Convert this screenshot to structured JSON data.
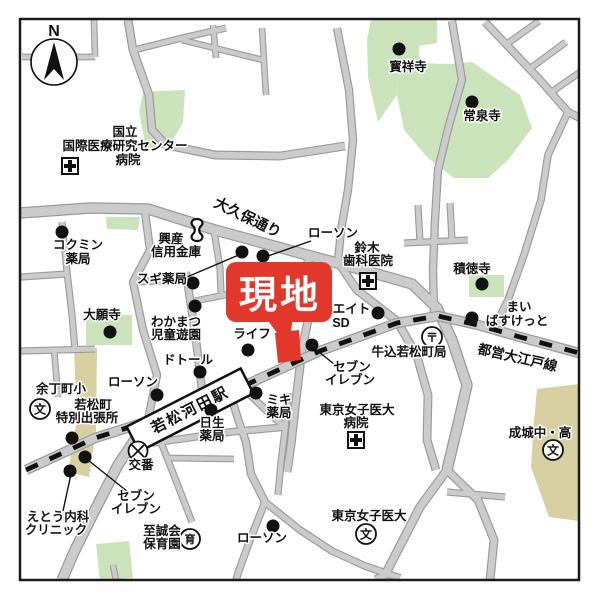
{
  "map": {
    "compass": {
      "label": "N"
    },
    "site": {
      "callout_label": "現地"
    },
    "station": {
      "label": "若松河田駅"
    },
    "railway": {
      "label": "都営大江戸線"
    },
    "streets": {
      "okubo": {
        "label": "大久保通り"
      }
    },
    "colors": {
      "site_red": "#e2382b",
      "road_fill": "#cbcbcb",
      "road_edge": "#9b9b9b",
      "park_green": "#cbe3ba",
      "school_khaki": "#d8d0a0",
      "railway_black": "#111111",
      "frame_black": "#1a1a1a"
    },
    "symbols": {
      "school_glyph": "文",
      "post_glyph": "〒",
      "nursery_glyph": "育"
    },
    "landmarks": {
      "nimc_hospital": {
        "lines": [
          "国立",
          "国際医療研究センター",
          "病院"
        ]
      },
      "hoshoji": {
        "label": "寳祥寺"
      },
      "josenji": {
        "label": "常泉寺"
      },
      "kokumin_pharmacy": {
        "lines": [
          "コクミン",
          "薬局"
        ]
      },
      "kosan_shinkin": {
        "lines": [
          "興産",
          "信用金庫"
        ]
      },
      "sugi_pharmacy": {
        "label": "スギ薬局"
      },
      "lawson_north": {
        "label": "ローソン"
      },
      "suzuki_dental": {
        "lines": [
          "鈴木",
          "歯科医院"
        ]
      },
      "sekitokuji": {
        "label": "積徳寺"
      },
      "my_basket": {
        "lines": [
          "まい",
          "ばすけっと"
        ]
      },
      "create_sd": {
        "lines": [
          "クリエイト",
          "SD"
        ]
      },
      "ushigome_wakamatsucho_post": {
        "label": "牛込若松町局"
      },
      "daiganji": {
        "label": "大願寺"
      },
      "wakamatsu_playground": {
        "lines": [
          "わかまつ",
          "児童遊園"
        ]
      },
      "life_supermarket": {
        "label": "ライフ"
      },
      "seven_eleven_center": {
        "lines": [
          "セブン",
          "イレブン"
        ]
      },
      "doutor": {
        "label": "ドトール"
      },
      "lawson_west": {
        "label": "ローソン"
      },
      "yochomachi_elementary": {
        "label": "余丁町小"
      },
      "wakamatsucho_branch_office": {
        "lines": [
          "若松町",
          "特別出張所"
        ]
      },
      "koban": {
        "label": "交番"
      },
      "miki_pharmacy": {
        "lines": [
          "ミキ",
          "薬局"
        ]
      },
      "nissei_pharmacy": {
        "lines": [
          "日生",
          "薬局"
        ]
      },
      "twmu_hospital": {
        "lines": [
          "東京女子医大",
          "病院"
        ]
      },
      "twmu": {
        "label": "東京女子医大"
      },
      "seijo_school": {
        "label": "成城中・高"
      },
      "eto_clinic": {
        "lines": [
          "えとう内科",
          "クリニック"
        ]
      },
      "seven_eleven_southwest": {
        "lines": [
          "セブン",
          "イレブン"
        ]
      },
      "shiseikai_nursery": {
        "lines": [
          "至誠会",
          "保育園"
        ]
      },
      "lawson_south": {
        "label": "ローソン"
      }
    }
  }
}
